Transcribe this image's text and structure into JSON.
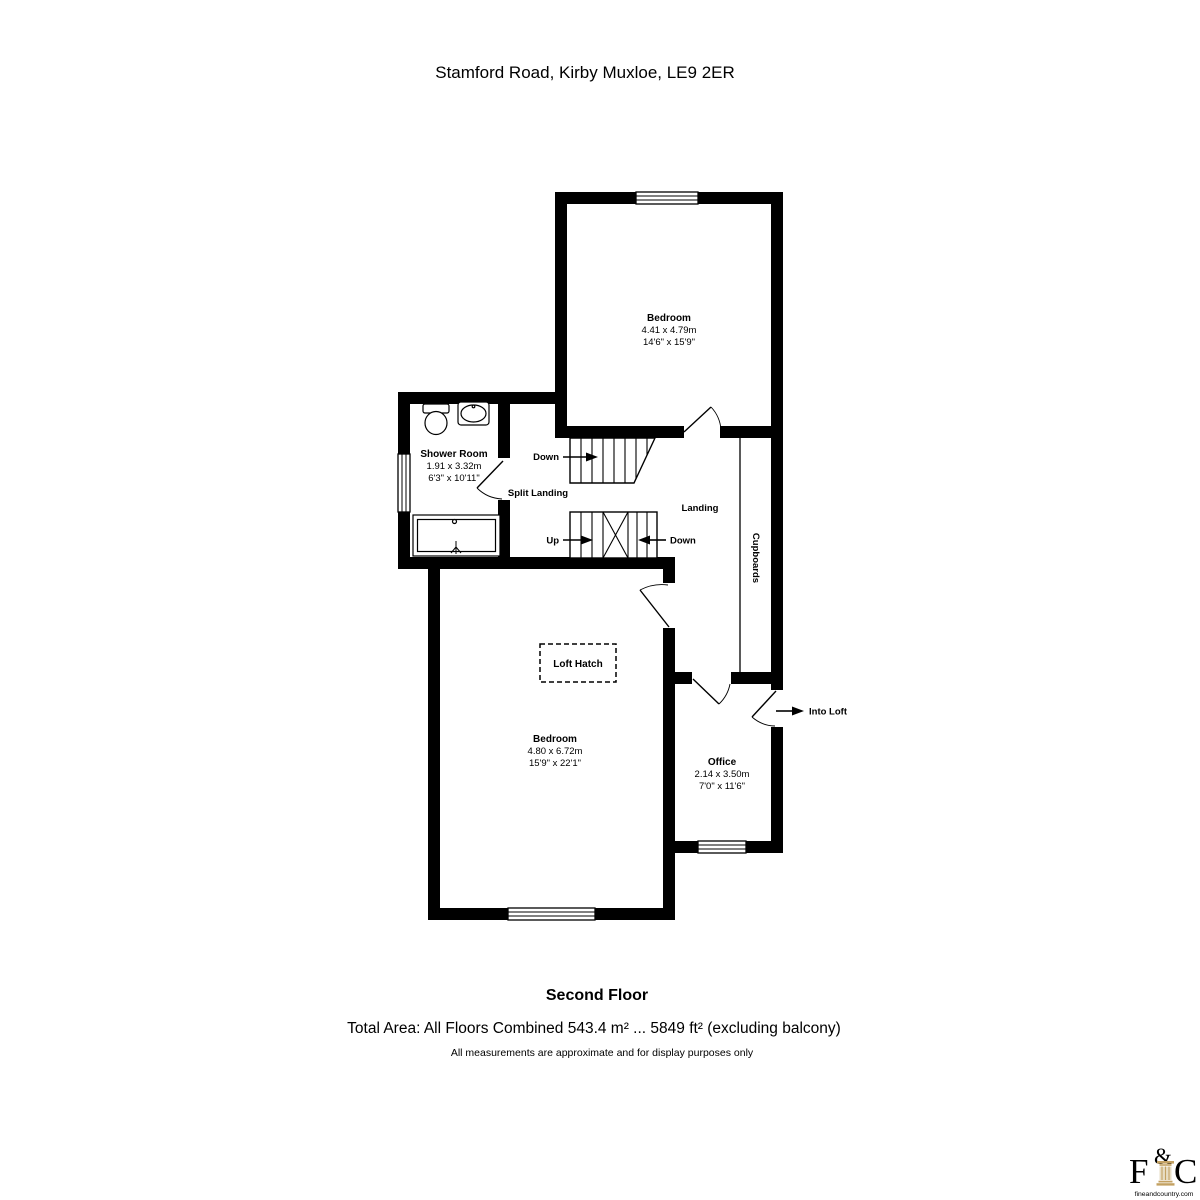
{
  "title": "Stamford Road, Kirby Muxloe, LE9 2ER",
  "rooms": {
    "bedroom_top": {
      "name": "Bedroom",
      "metric": "4.41 x 4.79m",
      "imperial": "14'6\" x 15'9\""
    },
    "shower_room": {
      "name": "Shower Room",
      "metric": "1.91 x 3.32m",
      "imperial": "6'3\" x 10'11\""
    },
    "bedroom_main": {
      "name": "Bedroom",
      "metric": "4.80 x 6.72m",
      "imperial": "15'9\" x 22'1\""
    },
    "office": {
      "name": "Office",
      "metric": "2.14 x 3.50m",
      "imperial": "7'0\" x 11'6\""
    }
  },
  "labels": {
    "split_landing": "Split Landing",
    "landing": "Landing",
    "cupboards": "Cupboards",
    "loft_hatch": "Loft Hatch",
    "stairs_down_top": "Down",
    "stairs_up": "Up",
    "stairs_down_mid": "Down",
    "into_loft": "Into Loft"
  },
  "footer": {
    "floor_name": "Second Floor",
    "total_area": "Total Area: All Floors Combined 543.4 m² ... 5849 ft² (excluding balcony)",
    "disclaimer": "All measurements are approximate and for display purposes only"
  },
  "logo": {
    "f": "F",
    "amp": "&",
    "c": "C",
    "website": "fineandcountry.com",
    "letter_color": "#9b9b9b",
    "accent_color": "#c3a162"
  },
  "colors": {
    "wall": "#000000",
    "text": "#000000",
    "background": "#ffffff"
  }
}
